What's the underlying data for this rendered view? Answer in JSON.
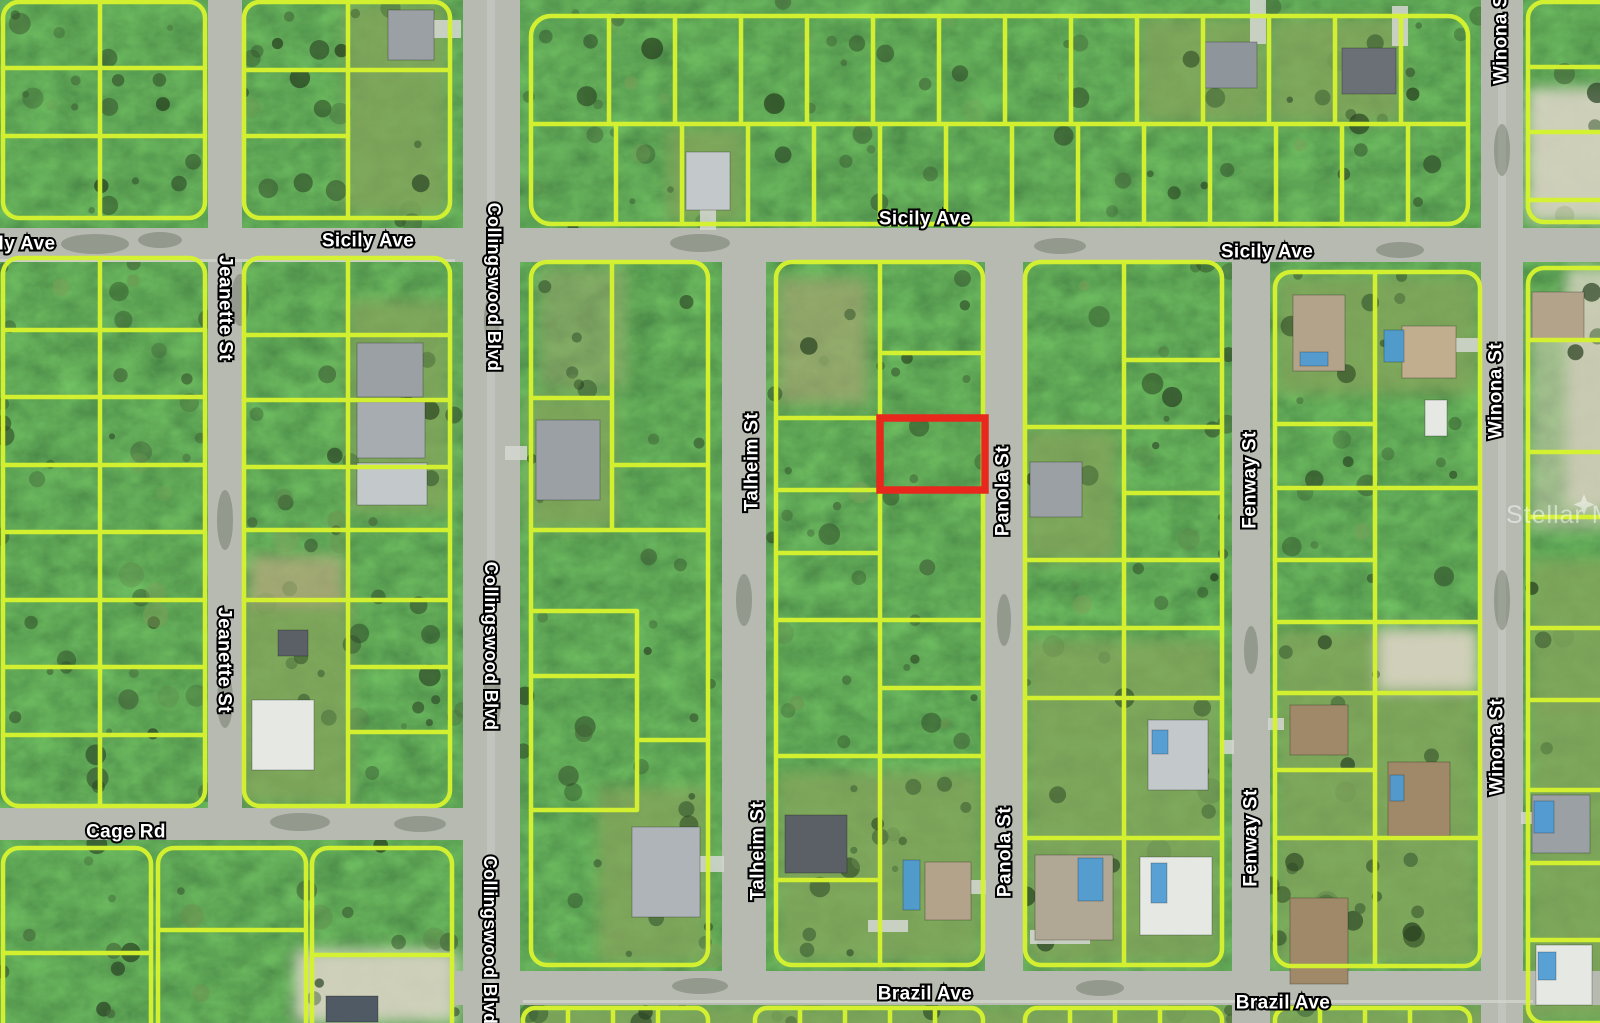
{
  "map": {
    "description": "Aerial satellite parcel map with lot boundary overlay and highlighted subject lot",
    "colors": {
      "parcel_line": "#d6f32f",
      "highlight_outline": "#e8281c",
      "road": "#b6bab1",
      "vegetation": "#41603a"
    },
    "highlight_parcel": {
      "name": "subject-lot",
      "outline_color": "#e8281c"
    },
    "watermark": {
      "text": "Stellar MLS",
      "icon": "sparkle-icon"
    },
    "street_labels": [
      {
        "text": "ly Ave",
        "orientation": "horizontal"
      },
      {
        "text": "Sicily Ave",
        "orientation": "horizontal"
      },
      {
        "text": "Sicily Ave",
        "orientation": "horizontal"
      },
      {
        "text": "Sicily Ave",
        "orientation": "horizontal"
      },
      {
        "text": "Jeanette St",
        "orientation": "vertical"
      },
      {
        "text": "Jeanette St",
        "orientation": "vertical"
      },
      {
        "text": "Collingswood Blvd",
        "orientation": "vertical"
      },
      {
        "text": "Collingswood Blvd",
        "orientation": "vertical"
      },
      {
        "text": "Collingswood Blvd",
        "orientation": "vertical"
      },
      {
        "text": "Talheim St",
        "orientation": "vertical"
      },
      {
        "text": "Talheim St",
        "orientation": "vertical"
      },
      {
        "text": "Panola St",
        "orientation": "vertical"
      },
      {
        "text": "Panola St",
        "orientation": "vertical"
      },
      {
        "text": "Fenway St",
        "orientation": "vertical"
      },
      {
        "text": "Fenway St",
        "orientation": "vertical"
      },
      {
        "text": "Winona St",
        "orientation": "vertical"
      },
      {
        "text": "Winona St",
        "orientation": "vertical"
      },
      {
        "text": "Winona St",
        "orientation": "vertical"
      },
      {
        "text": "Cage Rd",
        "orientation": "horizontal"
      },
      {
        "text": "Brazil Ave",
        "orientation": "horizontal"
      },
      {
        "text": "Brazil Ave",
        "orientation": "horizontal"
      }
    ]
  }
}
